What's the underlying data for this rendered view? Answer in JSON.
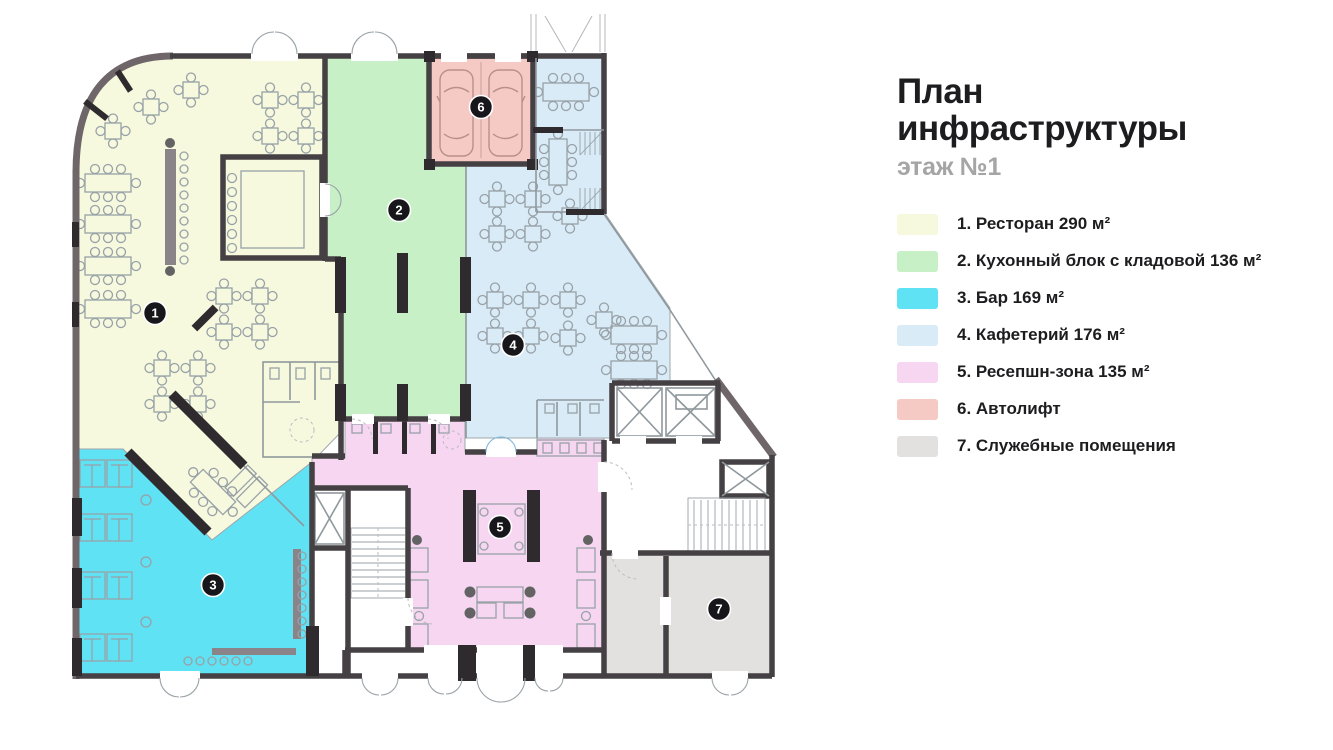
{
  "header": {
    "title_line1": "План",
    "title_line2": "инфраструктуры",
    "subtitle": "этаж №1"
  },
  "rooms": [
    {
      "number": "1",
      "legend_label": "1. Ресторан 290 м²",
      "color": "#f6f9de"
    },
    {
      "number": "2",
      "legend_label": "2. Кухонный блок с кладовой 136 м²",
      "color": "#c8f0c6"
    },
    {
      "number": "3",
      "legend_label": "3. Бар 169 м²",
      "color": "#5fe2f4"
    },
    {
      "number": "4",
      "legend_label": "4. Кафетерий 176 м²",
      "color": "#d9ebf7"
    },
    {
      "number": "5",
      "legend_label": "5. Ресепшн-зона 135 м²",
      "color": "#f6d6f1"
    },
    {
      "number": "6",
      "legend_label": "6. Автолифт",
      "color": "#f6cac4"
    },
    {
      "number": "7",
      "legend_label": "7. Служебные помещения",
      "color": "#e3e1e0"
    }
  ]
}
